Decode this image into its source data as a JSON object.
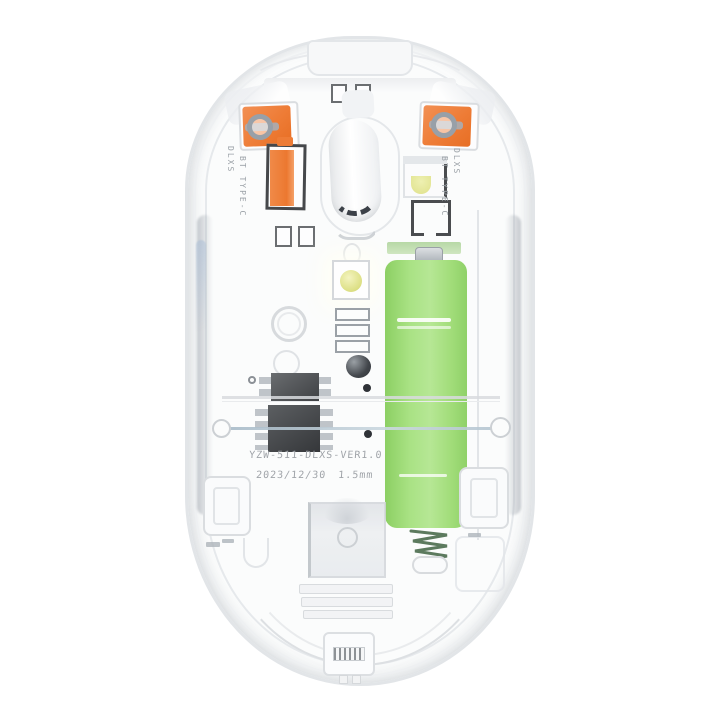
{
  "scene": {
    "subject": "Transparent wireless mouse - internal components view",
    "background": "#ffffff"
  },
  "colors": {
    "shell_outline": "#e2e5e8",
    "switch_orange": "#ee7c36",
    "battery_green": "#a9e284",
    "spring_green": "#5c7a5e",
    "chip_dark": "#3c3f43",
    "metal_gray": "#9aa1a8",
    "wire_blue": "#a4b8c6",
    "led_yellow": "#dfe18a",
    "silkscreen_text": "#9ba1a7"
  },
  "silkscreen": {
    "left": {
      "line1": "DLXS",
      "line2": "BT TYPE-C"
    },
    "right": {
      "line1": "DLXS",
      "line2": "BT TYPE-C"
    }
  },
  "pcb": {
    "model": "YZW-511-DLXS-VER1.0",
    "date": "2023/12/30 1.5mm"
  }
}
